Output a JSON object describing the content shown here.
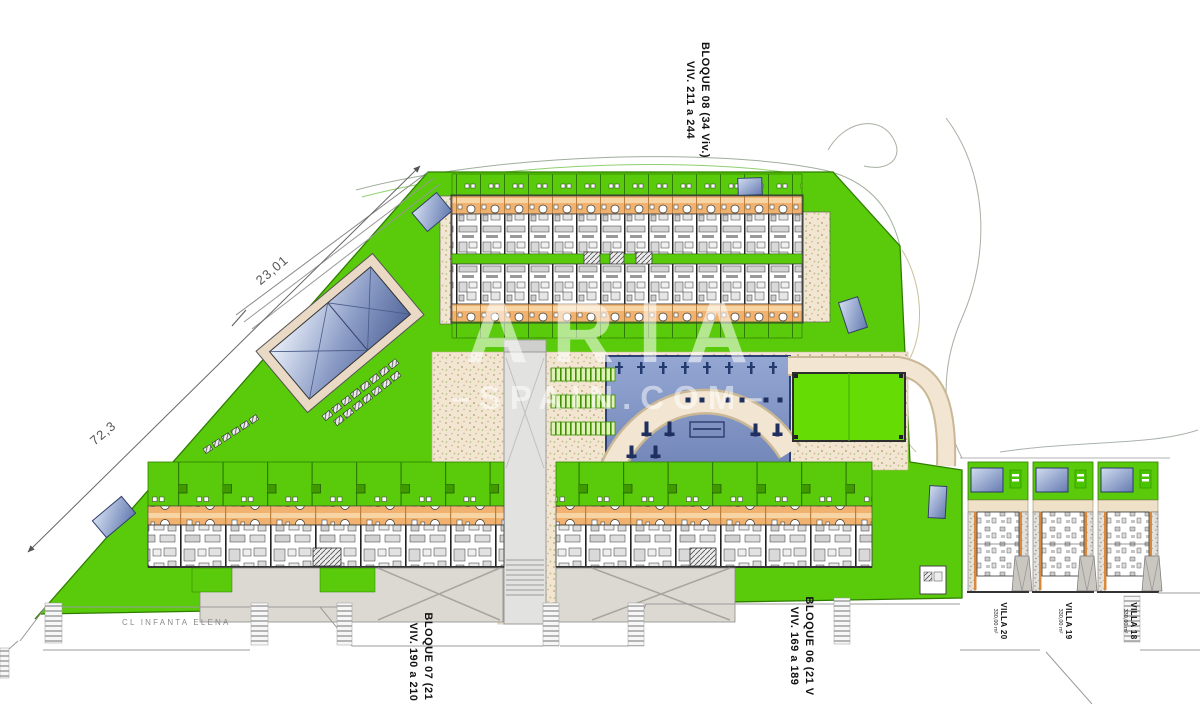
{
  "watermark": {
    "line1": "ARIA",
    "line2": "–SPAIN.COM–"
  },
  "labels": {
    "bloque08_line1": "BLOQUE 08 (34 Viv.)",
    "bloque08_line2": "VIV. 211 a 244",
    "bloque07_line1": "BLOQUE 07 (21 V",
    "bloque07_line2": "VIV. 190 a 210",
    "bloque06_line1": "BLOQUE 06 (21 V",
    "bloque06_line2": "VIV. 169 a 189"
  },
  "villas": [
    {
      "name": "VILLA 20",
      "area": "330,00 m²"
    },
    {
      "name": "VILLA 19",
      "area": "330,00 m²"
    },
    {
      "name": "VILLA 18",
      "area": "330,00 m²"
    }
  ],
  "road": {
    "name": "CL INFANTA ELENA"
  },
  "dimensions": {
    "edge_upper": "23,01",
    "edge_lower": "72,3"
  },
  "colors": {
    "lawn": "#59cb0a",
    "court": "#65dd05",
    "terrace": "#f0b26e",
    "path_beige": "#f2e6d2",
    "pool_dark": "#5d74ad"
  }
}
